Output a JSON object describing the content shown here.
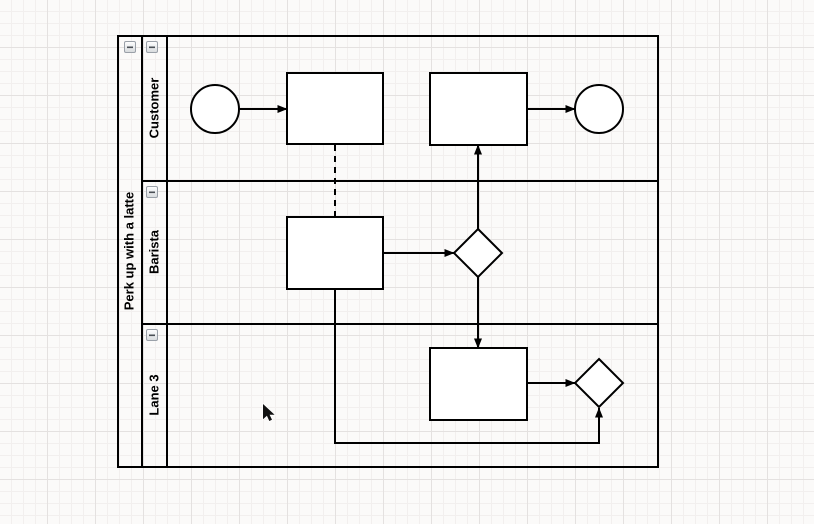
{
  "theme": {
    "stroke": "#000000",
    "shape_fill": "#ffffff",
    "canvas_bg": "#fbfaf9",
    "grid_minor": "#f2efee",
    "grid_major": "#e4e1e0",
    "btn_border": "#9aa0a8",
    "btn_face_top": "#ffffff",
    "btn_face_bottom": "#d7dadd",
    "label_color": "#000000"
  },
  "pool": {
    "title": "Perk up with a latte",
    "collapse_icon": "minus-icon",
    "lanes": [
      {
        "label": "Customer",
        "collapse_icon": "minus-icon"
      },
      {
        "label": "Barista",
        "collapse_icon": "minus-icon"
      },
      {
        "label": "Lane 3",
        "collapse_icon": "minus-icon"
      }
    ]
  },
  "diagram": {
    "nodes": [
      {
        "id": "start-event",
        "type": "circle",
        "lane": "Customer",
        "label": ""
      },
      {
        "id": "task-1",
        "type": "rectangle",
        "lane": "Customer",
        "label": ""
      },
      {
        "id": "task-2",
        "type": "rectangle",
        "lane": "Customer",
        "label": ""
      },
      {
        "id": "end-event",
        "type": "circle",
        "lane": "Customer",
        "label": ""
      },
      {
        "id": "task-3",
        "type": "rectangle",
        "lane": "Barista",
        "label": ""
      },
      {
        "id": "gateway-1",
        "type": "diamond",
        "lane": "Barista",
        "label": ""
      },
      {
        "id": "task-4",
        "type": "rectangle",
        "lane": "Lane 3",
        "label": ""
      },
      {
        "id": "gateway-2",
        "type": "diamond",
        "lane": "Lane 3",
        "label": ""
      }
    ],
    "edges": [
      {
        "from": "start-event",
        "to": "task-1",
        "style": "solid-arrow"
      },
      {
        "from": "task-2",
        "to": "end-event",
        "style": "solid-arrow"
      },
      {
        "from": "task-1",
        "to": "task-3",
        "style": "dashed-association"
      },
      {
        "from": "task-3",
        "to": "gateway-1",
        "style": "solid-arrow"
      },
      {
        "from": "gateway-1",
        "to": "task-2",
        "style": "solid-arrow"
      },
      {
        "from": "gateway-1",
        "to": "task-4",
        "style": "solid-arrow"
      },
      {
        "from": "task-4",
        "to": "gateway-2",
        "style": "solid-arrow"
      },
      {
        "from": "task-3",
        "to": "gateway-2",
        "style": "solid-arrow-orthogonal"
      }
    ]
  },
  "cursor": {
    "style": "arrow-pointer"
  }
}
